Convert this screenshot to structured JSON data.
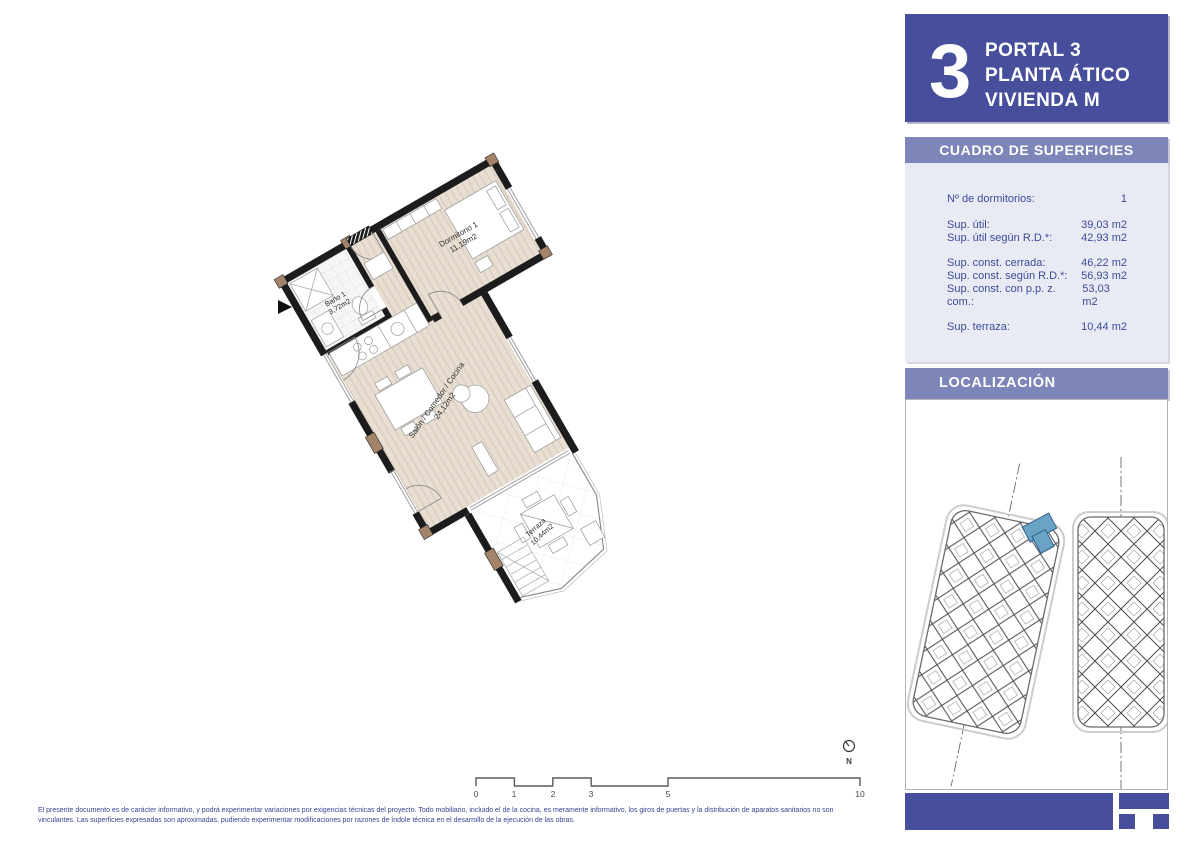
{
  "header": {
    "number": "3",
    "line1": "PORTAL 3",
    "line2": "PLANTA ÁTICO",
    "line3": "VIVIENDA M"
  },
  "surfaces": {
    "title": "CUADRO DE SUPERFICIES",
    "bedrooms": {
      "label": "Nº de dormitorios:",
      "value": "1"
    },
    "util": [
      {
        "label": "Sup. útil:",
        "value": "39,03 m2"
      },
      {
        "label": "Sup. útil según R.D.*:",
        "value": "42,93 m2"
      }
    ],
    "const": [
      {
        "label": "Sup. const. cerrada:",
        "value": "46,22 m2"
      },
      {
        "label": "Sup. const. según R.D.*:",
        "value": "56,93 m2"
      },
      {
        "label": "Sup. const. con p.p. z. com.:",
        "value": "53,03 m2"
      }
    ],
    "terraza": {
      "label": "Sup. terraza:",
      "value": "10,44 m2"
    }
  },
  "localization": {
    "title": "LOCALIZACIÓN"
  },
  "plan": {
    "rooms": [
      {
        "name": "Baño 1",
        "area": "3,72m2"
      },
      {
        "name": "Dormitorio 1",
        "area": "11,19m2"
      },
      {
        "name": "Salón / Comedor / Cocina",
        "area": "24,12m2"
      },
      {
        "name": "Terraza",
        "area": "10,44m2"
      }
    ]
  },
  "scale_bar": {
    "labels": [
      "0",
      "1",
      "2",
      "3",
      "5",
      "10"
    ]
  },
  "compass": {
    "label": "N"
  },
  "disclaimer": {
    "line1": "El presente documento es de carácter informativo, y podrá experimentar variaciones por exigencias técnicas del proyecto. Todo mobiliario, incluido el de la cocina, es meramente informativo, los giros de puertas y la distribución de aparatos sanitarios no son",
    "line2": "vinculantes. Las superficies expresadas son aproximadas, pudiendo experimentar modificaciones por razones de índole técnica en el desarrollo de la ejecución de las obras."
  },
  "colors": {
    "primary_blue": "#474e9c",
    "bar_purple": "#7d85b9",
    "panel_bg": "#e9ebf4",
    "table_text": "#3d4a99",
    "wall_black": "#1c1c1c",
    "floor_beige": "#e8ded2",
    "accent_brown": "#a3846a",
    "highlight_unit": "#6ba3c6"
  }
}
